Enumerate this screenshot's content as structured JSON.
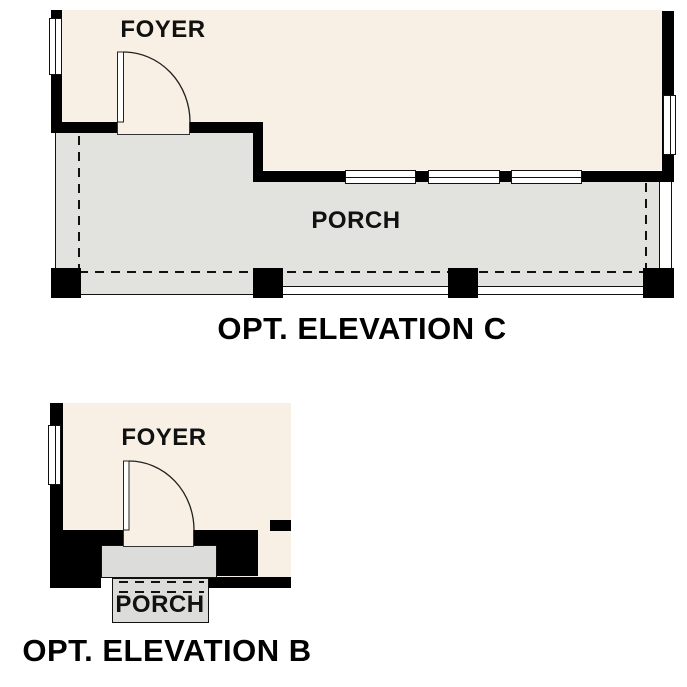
{
  "plans": [
    {
      "id": "elevation-c",
      "title": "OPT. ELEVATION C",
      "rooms": {
        "foyer": "FOYER",
        "porch": "PORCH"
      }
    },
    {
      "id": "elevation-b",
      "title": "OPT. ELEVATION B",
      "rooms": {
        "foyer": "FOYER",
        "porch": "PORCH"
      }
    }
  ],
  "colors": {
    "floor_beige": "#f8f0e4",
    "porch_gray": "#e2e2df",
    "stoop_gray": "#dcdcda",
    "wall_black": "#000000",
    "line_dark": "#111111",
    "background": "#ffffff"
  }
}
